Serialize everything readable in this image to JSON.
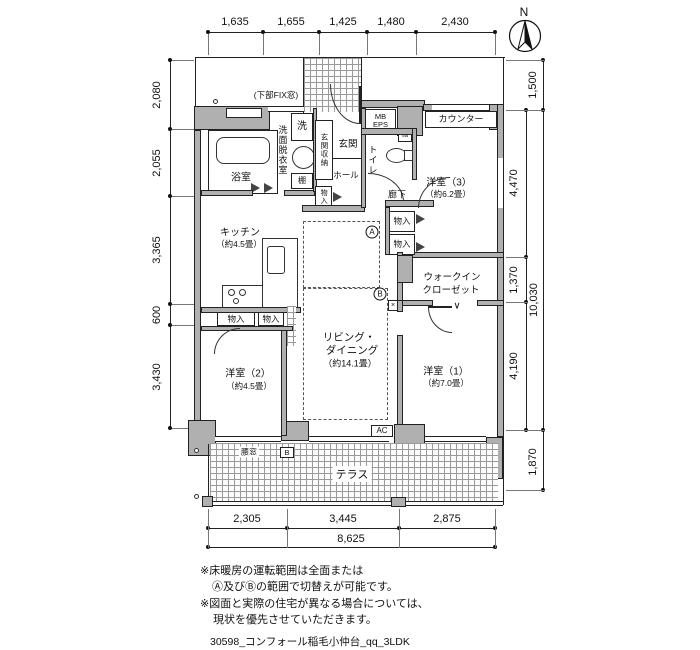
{
  "compass": {
    "n": "N"
  },
  "window_note": "(下部FIX窓)",
  "dims": {
    "top": [
      "1,635",
      "1,655",
      "1,425",
      "1,480",
      "2,430"
    ],
    "left": [
      "2,080",
      "2,055",
      "3,365",
      "600",
      "3,430"
    ],
    "right_inner": [
      "4,470",
      "1,370",
      "4,190"
    ],
    "right_outer_top": "1,500",
    "right_total": "10,030",
    "right_outer_bottom": "1,870",
    "bottom": [
      "2,305",
      "3,445",
      "2,875"
    ],
    "bottom_total": "8,625"
  },
  "rooms": {
    "bath": "浴室",
    "washroom": "洗面脱衣室",
    "washer": "洗",
    "shelf": "棚",
    "entrance_storage": "玄関収納",
    "entrance": "玄関",
    "hall": "ホール",
    "toilet": "トイレ",
    "mb": "MB",
    "eps": "EPS",
    "counter": "カウンター",
    "room3": "洋室（3）",
    "room3_size": "（約6.2畳）",
    "corridor": "廊下",
    "closet": "物入",
    "wic_line1": "ウォークイン",
    "wic_line2": "クローゼット",
    "kitchen": "キッチン",
    "kitchen_size": "（約4.5畳）",
    "living_line1": "リビング・",
    "living_line2": "ダイニング",
    "living_size": "（約14.1畳）",
    "room2": "洋室（2）",
    "room2_size": "（約4.5畳）",
    "room1": "洋室（1）",
    "room1_size": "（約7.0畳）",
    "terrace": "テラス",
    "waist_window": "腰窓",
    "ac": "AC",
    "heat_zone_a": "A",
    "heat_zone_b": "B",
    "b_box": "B"
  },
  "symbols": {
    "chevron": "∨",
    "cross": "×"
  },
  "notes": [
    "※床暖房の運転範囲は全面または",
    "Ⓐ及びⒷの範囲で切替えが可能です。",
    "※図面と実際の住宅が異なる場合については、",
    "現状を優先させていただきます。"
  ],
  "caption": "30598_コンフォール稲毛小仲台_qq_3LDK"
}
